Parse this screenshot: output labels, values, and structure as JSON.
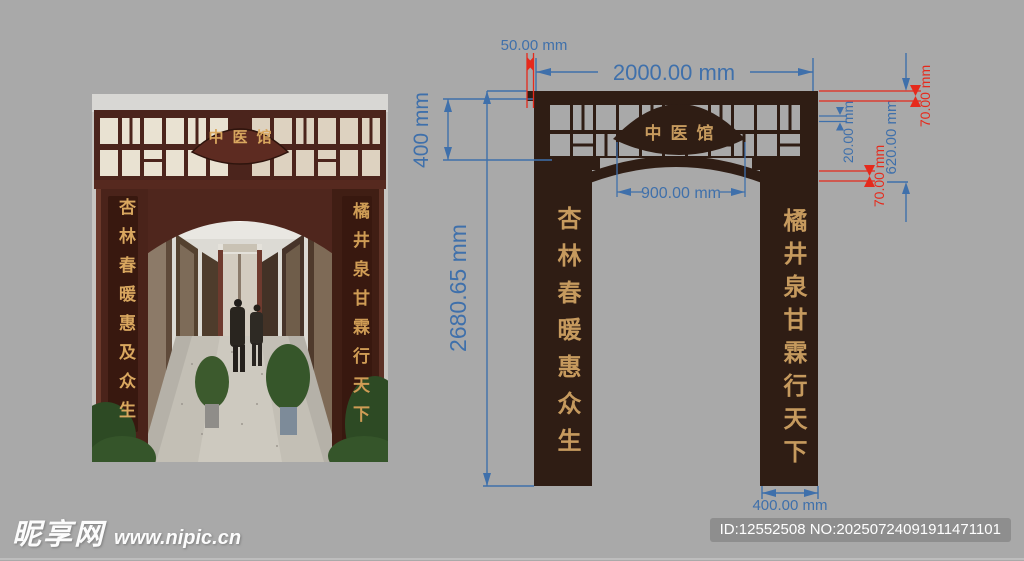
{
  "page": {
    "background": "#a9a9a9"
  },
  "photo": {
    "sign": "中医馆",
    "couplet_left": "杏林春暖惠及众生",
    "couplet_right": "橘井泉甘霖行天下"
  },
  "diagram": {
    "sign": "中医馆",
    "couplet_left": "杏林春暖惠众生",
    "couplet_right": "橘井泉甘霖行天下",
    "colors": {
      "wood": "#2f1d14",
      "gold": "#c69a5e",
      "dim_blue": "#3f70ab",
      "dim_red": "#e62a1c"
    },
    "dims": {
      "offset_top": "50.00 mm",
      "total_width": "2000.00 mm",
      "header_height": "400 mm",
      "column_height": "2680.65 mm",
      "sign_width": "900.00 mm",
      "muntin": "20.00 mm",
      "header_band": "620.00 mm",
      "beam": "70.00 mm",
      "rail": "70.00 mm",
      "column_width": "400.00 mm"
    }
  },
  "footer": {
    "site_name": "昵享网",
    "site_url": "www.nipic.cn",
    "id_text": "ID:12552508 NO:20250724091911471101"
  }
}
